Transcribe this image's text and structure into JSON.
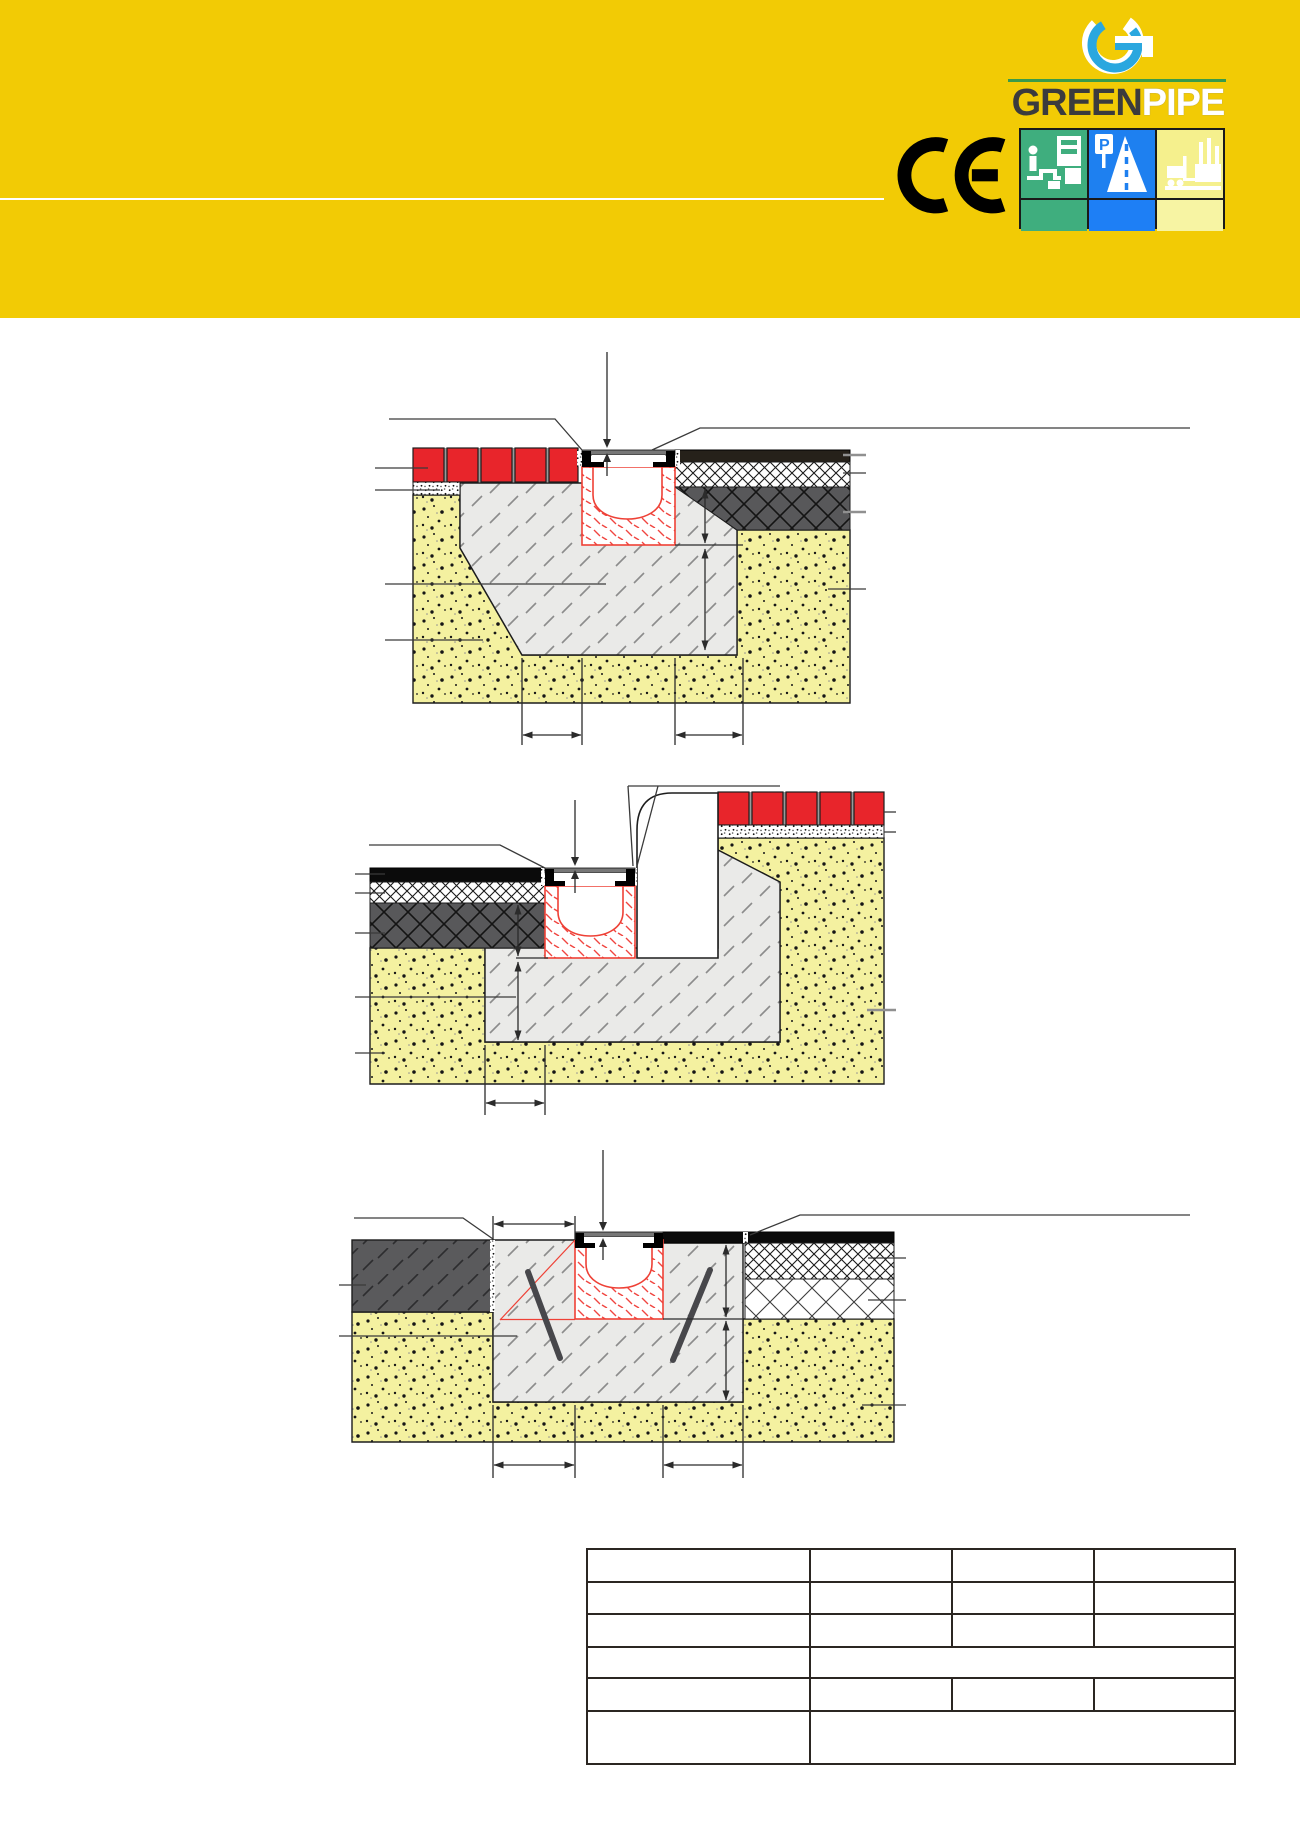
{
  "header": {
    "band_color": "#F2CB05",
    "divider_color": "#FFFFFF",
    "logo": {
      "green": "GREEN",
      "pipe": "PIPE",
      "green_color": "#3B3B3D",
      "pipe_color": "#FFFFFF",
      "rule_color": "#3A9B4A",
      "g_mark_blue": "#2AA7DF"
    },
    "ce_mark": "CE",
    "application_icons": [
      {
        "name": "pedestrian-truck-icon",
        "color": "#3FAE7E"
      },
      {
        "name": "parking-road-icon",
        "color": "#1E80F0"
      },
      {
        "name": "industrial-forklift-icon",
        "color": "#F5F08D"
      }
    ]
  },
  "drawing_colors": {
    "channel_red": "#EE4136",
    "paver_red": "#E8252B",
    "paver_joint_gray": "#9A9A9A",
    "concrete_gray": "#EAEAE8",
    "soil_yellow": "#F4F1A0",
    "asphalt_dark_brown": "#26211A",
    "asphalt_black": "#0B0B0B",
    "base_layer_dark_gray": "#58585A",
    "line_color": "#2B2B2B",
    "leader_gray": "#909090"
  },
  "diagrams": [
    {
      "name": "cross-section-channel-in-block-paving"
    },
    {
      "name": "cross-section-channel-at-curb-asphalt"
    },
    {
      "name": "cross-section-channel-in-reinforced-concrete"
    }
  ],
  "table": {
    "rows": [
      [
        "",
        "",
        "",
        ""
      ],
      [
        "",
        "",
        "",
        ""
      ],
      [
        "",
        "",
        "",
        ""
      ],
      [
        "",
        ""
      ],
      [
        "",
        "",
        "",
        ""
      ],
      [
        "",
        ""
      ]
    ]
  }
}
